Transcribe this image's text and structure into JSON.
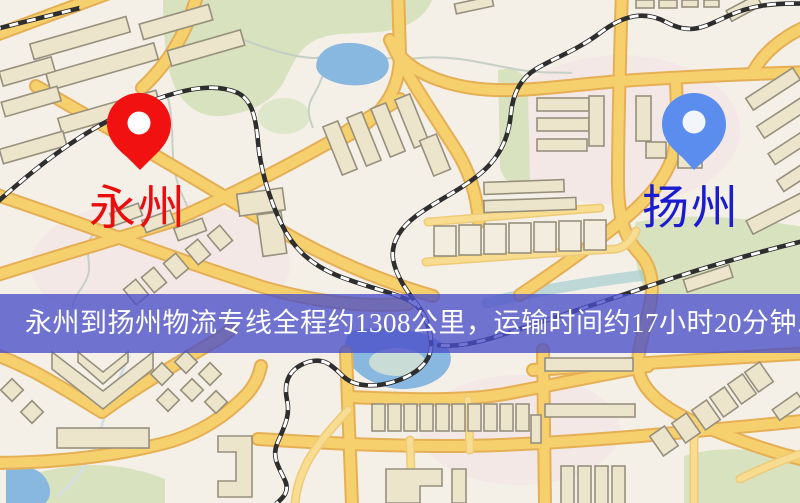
{
  "banner": {
    "text": "永州到扬州物流专线全程约1308公里，运输时间约17小时20分钟.",
    "background_color": "#4a4ec9",
    "background_opacity": "0.78",
    "text_color": "#ffffff"
  },
  "markers": {
    "origin": {
      "label": "永州",
      "pin_color": "#f21111",
      "label_color": "#e90d0d"
    },
    "destination": {
      "label": "扬州",
      "pin_color": "#5a8dee",
      "label_color": "#1b1bd0"
    }
  },
  "map_colors": {
    "background": "#f4efe7",
    "road_fill": "#f7d06e",
    "road_casing": "#e5af55",
    "minor_road_fill": "#f8dc8f",
    "minor_road_casing": "#eecb79",
    "park": "#d8e2bf",
    "park_light": "#dee7c9",
    "water": "#88b8e0",
    "water_stream": "#92c4cb",
    "building_fill": "#ece5cc",
    "building_stroke": "#97907d",
    "building_light": "#f2eddf",
    "railway": "#2e2e2e",
    "pin_hole": "#ffffff"
  }
}
